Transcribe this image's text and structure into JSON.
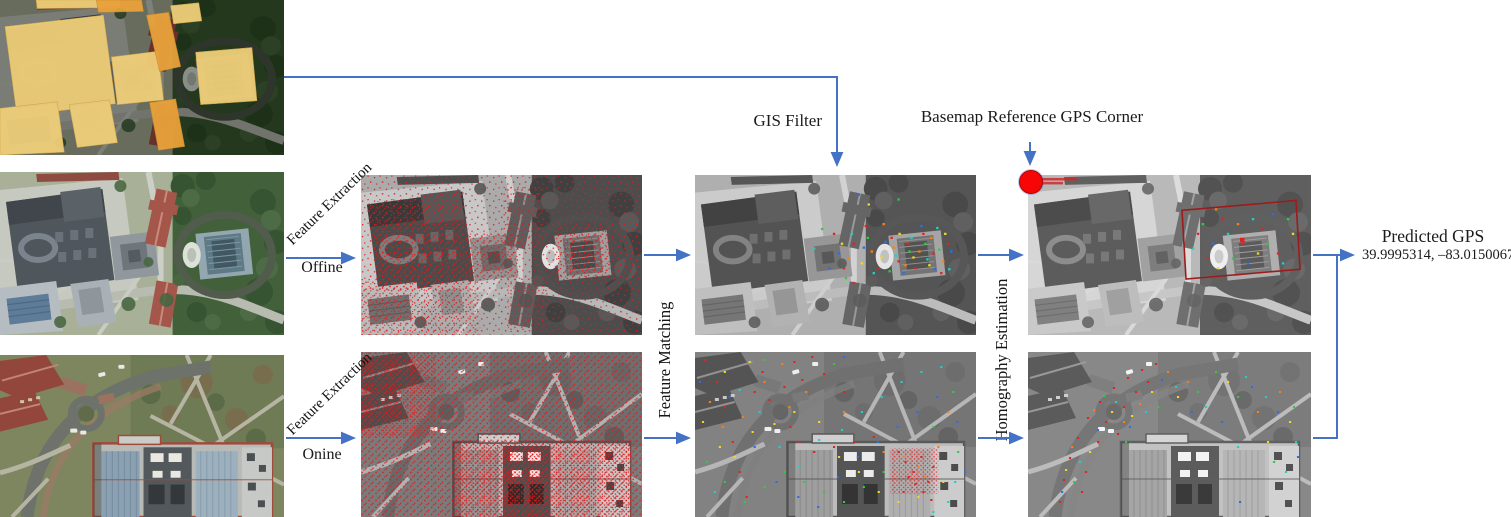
{
  "labels": {
    "gis_filter": "GIS Filter",
    "basemap_reference_gps_corner": "Basemap Reference GPS Corner",
    "fe_offline": {
      "title": "Feature Extraction",
      "mode": "Offine"
    },
    "fe_online": {
      "title": "Feature Extraction",
      "mode": "Onine"
    },
    "feature_matching": "Feature Matching",
    "homography_estimation": "Homography Estimation",
    "predicted_gps": {
      "title": "Predicted GPS",
      "value": "39.9995314, –83.0150067"
    }
  },
  "colors": {
    "arrow_blue": "#4472C4",
    "reference_marker_red": "#F60606",
    "feature_point_red": "#E01B1B",
    "gis_footprint_yellow": "#EFCF79",
    "gis_footprint_orange": "#E9A23B",
    "homography_box_red": "#9E1B1B"
  }
}
